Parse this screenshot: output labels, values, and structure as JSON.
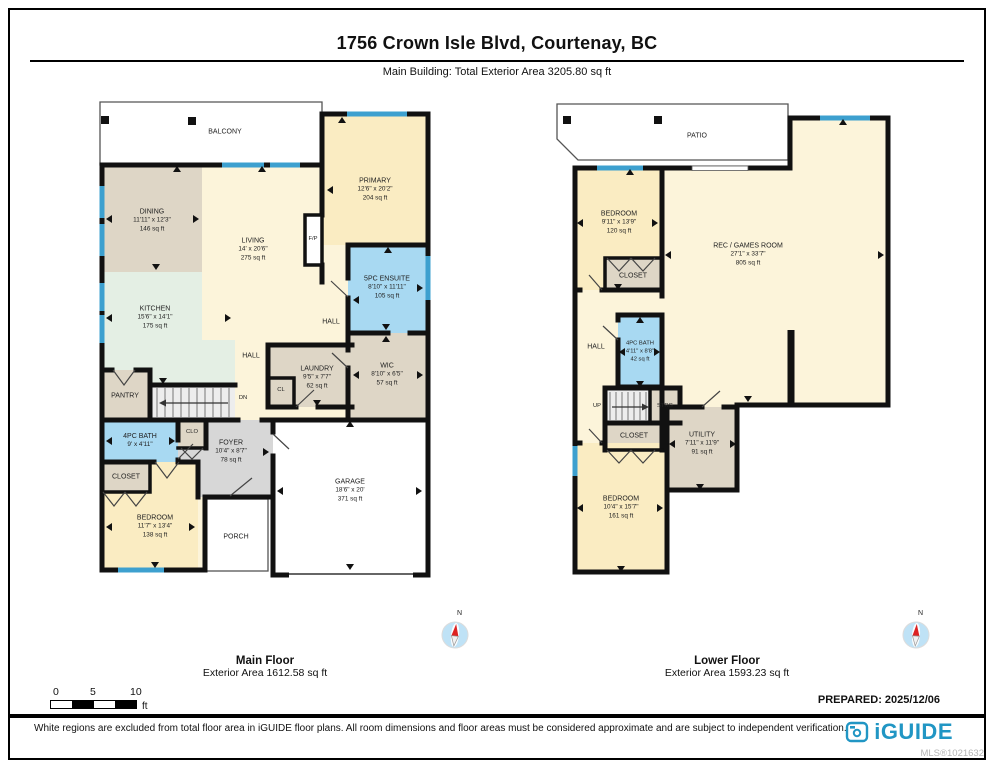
{
  "page": {
    "title": "1756 Crown Isle Blvd, Courtenay, BC",
    "subtitle": "Main Building: Total Exterior Area 3205.80 sq ft",
    "prepared": "PREPARED: 2025/12/06",
    "disclaimer": "White regions are excluded from total floor area in iGUIDE floor plans. All room dimensions and floor areas must be considered approximate and are subject to independent verification.",
    "brand": "iGUIDE",
    "mls": "MLS®1021632"
  },
  "scale_bar": {
    "ticks": [
      "0",
      "5",
      "10"
    ],
    "unit": "ft"
  },
  "compass": {
    "label": "N"
  },
  "colors": {
    "wall": "#111111",
    "window_blue": "#3da0cf",
    "room_cream": "#fcf4da",
    "room_yellow": "#faecc2",
    "room_tan": "#ded6c6",
    "room_mint": "#e4efe4",
    "room_bath_blue": "#a8d9f2",
    "room_foyer_gray": "#d7d7d7",
    "brand_teal": "#2196c4"
  },
  "floors": [
    {
      "label": "Main Floor",
      "area": "Exterior Area 1612.58 sq ft",
      "rooms": {
        "balcony": {
          "name": "BALCONY"
        },
        "dining": {
          "name": "DINING",
          "dims": "11'11\" x 12'3\"",
          "area": "146 sq ft"
        },
        "living": {
          "name": "LIVING",
          "dims": "14' x 20'6\"",
          "area": "275 sq ft"
        },
        "primary": {
          "name": "PRIMARY",
          "dims": "12'6\" x 20'2\"",
          "area": "204 sq ft"
        },
        "fp": {
          "name": "F/P"
        },
        "kitchen": {
          "name": "KITCHEN",
          "dims": "15'6\" x 14'1\"",
          "area": "175 sq ft"
        },
        "ensuite": {
          "name": "5PC ENSUITE",
          "dims": "8'10\" x 11'11\"",
          "area": "105 sq ft"
        },
        "hall_upper": {
          "name": "HALL"
        },
        "wic": {
          "name": "WIC",
          "dims": "8'10\" x 6'5\"",
          "area": "57 sq ft"
        },
        "hall_mid": {
          "name": "HALL"
        },
        "laundry": {
          "name": "LAUNDRY",
          "dims": "9'5\" x 7'7\"",
          "area": "62 sq ft"
        },
        "cl": {
          "name": "CL"
        },
        "pantry": {
          "name": "PANTRY"
        },
        "dn": {
          "name": "DN"
        },
        "bath": {
          "name": "4PC BATH",
          "dims": "9' x 4'11\""
        },
        "clo": {
          "name": "CLO"
        },
        "foyer": {
          "name": "FOYER",
          "dims": "10'4\" x 8'7\"",
          "area": "78 sq ft"
        },
        "closet": {
          "name": "CLOSET"
        },
        "bedroom": {
          "name": "BEDROOM",
          "dims": "11'7\" x 13'4\"",
          "area": "138 sq ft"
        },
        "porch": {
          "name": "PORCH"
        },
        "garage": {
          "name": "GARAGE",
          "dims": "18'6\" x 20'",
          "area": "371 sq ft"
        }
      }
    },
    {
      "label": "Lower Floor",
      "area": "Exterior Area 1593.23 sq ft",
      "rooms": {
        "patio": {
          "name": "PATIO"
        },
        "bedroom_upper": {
          "name": "BEDROOM",
          "dims": "9'11\" x 13'9\"",
          "area": "120 sq ft"
        },
        "closet_upper": {
          "name": "CLOSET"
        },
        "rec": {
          "name": "REC / GAMES ROOM",
          "dims": "27'1\" x 33'7\"",
          "area": "805 sq ft"
        },
        "hall": {
          "name": "HALL"
        },
        "bath": {
          "name": "4PC BATH",
          "dims": "4'11\" x 8'8\"",
          "area": "42 sq ft"
        },
        "up": {
          "name": "UP"
        },
        "strg": {
          "name": "STRG"
        },
        "closet_lower": {
          "name": "CLOSET"
        },
        "utility": {
          "name": "UTILITY",
          "dims": "7'11\" x 11'9\"",
          "area": "91 sq ft"
        },
        "bedroom_lower": {
          "name": "BEDROOM",
          "dims": "10'4\" x 15'7\"",
          "area": "161 sq ft"
        }
      }
    }
  ]
}
